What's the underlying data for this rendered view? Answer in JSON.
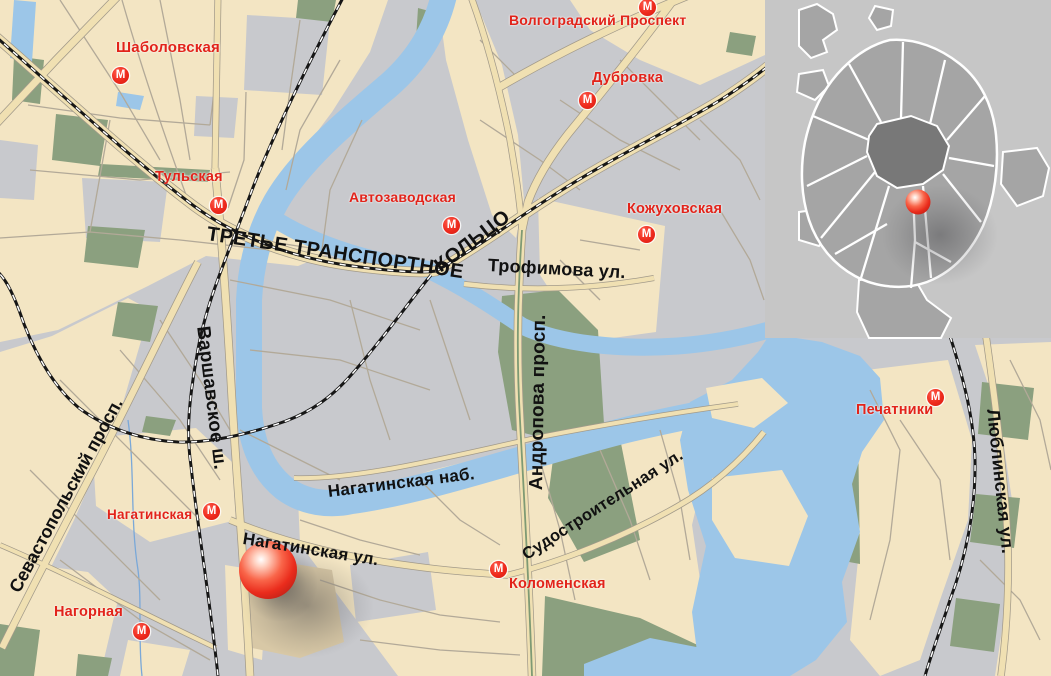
{
  "map": {
    "street_labels": [
      {
        "id": "ttk-line1",
        "text": "ТРЕТЬЕ ТРАНСПОРТНОЕ"
      },
      {
        "id": "ttk-line2",
        "text": "КОЛЬЦО"
      },
      {
        "id": "trofimova",
        "text": "Трофимова ул."
      },
      {
        "id": "sevastopolsky",
        "text": "Севастопольский просп."
      },
      {
        "id": "varshavskoe",
        "text": "Варшавское ш."
      },
      {
        "id": "andropova",
        "text": "Андропова просп."
      },
      {
        "id": "nagatinskaya-nab",
        "text": "Нагатинская наб."
      },
      {
        "id": "nagatinskaya-ul",
        "text": "Нагатинская ул."
      },
      {
        "id": "sudostroitelnaya",
        "text": "Судостроительная ул."
      },
      {
        "id": "lyublinskaya",
        "text": "Люблинская ул."
      }
    ],
    "metro_stations": [
      {
        "id": "shabolovskaya",
        "label": "Шаболовская"
      },
      {
        "id": "tulskaya",
        "label": "Тульская"
      },
      {
        "id": "volgogradsky-prospekt",
        "label": "Волгоградский Проспект"
      },
      {
        "id": "dubrovka",
        "label": "Дубровка"
      },
      {
        "id": "avtozavodskaya",
        "label": "Автозаводская"
      },
      {
        "id": "kozhukhovskaya",
        "label": "Кожуховская"
      },
      {
        "id": "nagatinskaya",
        "label": "Нагатинская"
      },
      {
        "id": "nagornaya",
        "label": "Нагорная"
      },
      {
        "id": "kolomenskaya",
        "label": "Коломенская"
      },
      {
        "id": "pechatniki",
        "label": "Печатники"
      }
    ],
    "metro_icon_letter": "М",
    "colors": {
      "land_block": "#f3e5c3",
      "urban_gray": "#c8c9cd",
      "park_green": "#8ba07f",
      "water_blue": "#9cc6e8",
      "road_fill": "#f0e0b2",
      "metro_red": "#ee2b22",
      "marker_red": "#e8301f",
      "railroad_black": "#161616"
    }
  },
  "inset": {
    "description": "Moscow overview with location marker"
  }
}
